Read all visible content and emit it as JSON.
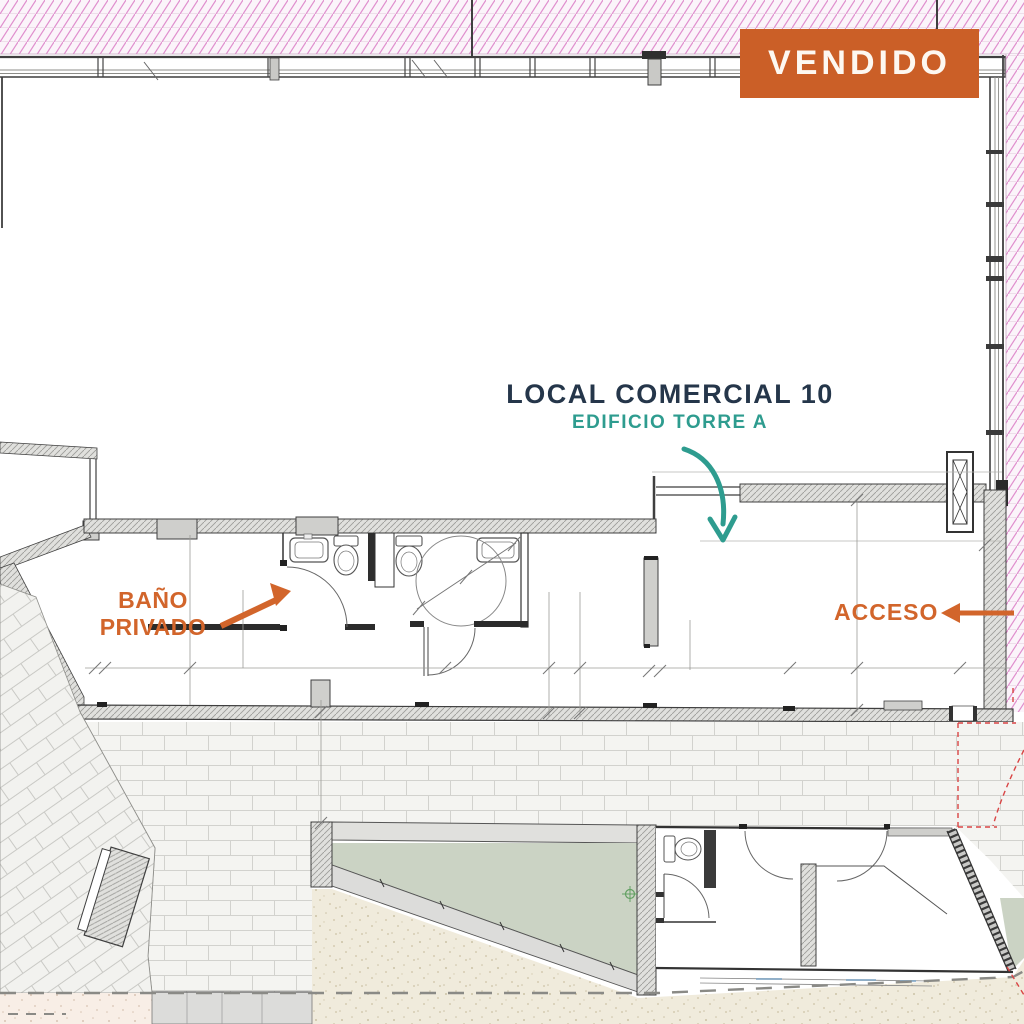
{
  "status_banner": {
    "label": "VENDIDO",
    "background_color": "#CB5F27",
    "text_color": "#FDF8F1"
  },
  "unit": {
    "name": "LOCAL COMERCIAL 10",
    "name_color": "#25364A",
    "building": "EDIFICIO TORRE A",
    "building_color": "#2E9C8F"
  },
  "callouts": {
    "private_bath": {
      "line1": "BAÑO",
      "line2": "PRIVADO",
      "color": "#D2652B",
      "arrow": "points-up-right-to-bath-door"
    },
    "access": {
      "label": "ACCESO",
      "color": "#D2652B",
      "arrow": "points-left-from-right-facade"
    },
    "entrance_arrow": {
      "color": "#2E9C8F",
      "arrow": "curves-down-into-unit"
    }
  },
  "plan_colors": {
    "neighbour_hatch_pink": "#E08FCE",
    "wall_line": "#3F3F3F",
    "wall_fill": "#E0E0DD",
    "brick_joint": "#D2D2CE",
    "planter_green": "#CBD3C4",
    "sand": "#F0EBDC",
    "sand_pink": "#F8EEE6",
    "red_boundary": "#D94545",
    "dimension_line": "#9B9B97",
    "survey_marker_green": "#63A063",
    "window_sill_blue": "#7FA8C9"
  }
}
